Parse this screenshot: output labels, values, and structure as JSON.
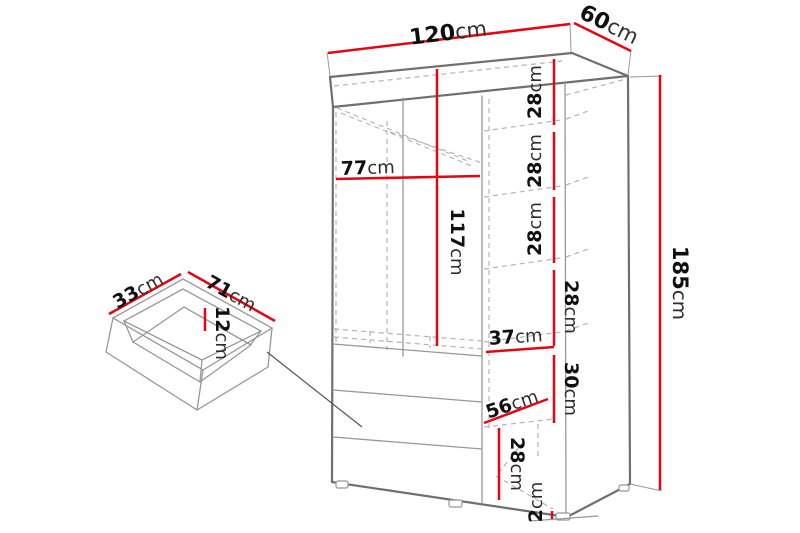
{
  "diagram": {
    "type": "furniture-dimension-diagram",
    "item": "wardrobe-with-drawer",
    "dims": {
      "width": {
        "num": "120",
        "unit": "cm"
      },
      "depth": {
        "num": "60",
        "unit": "cm"
      },
      "height": {
        "num": "185",
        "unit": "cm"
      },
      "left_section_width": {
        "num": "77",
        "unit": "cm"
      },
      "left_section_height": {
        "num": "117",
        "unit": "cm"
      },
      "shelf_gap_1": {
        "num": "28",
        "unit": "cm"
      },
      "shelf_gap_2": {
        "num": "28",
        "unit": "cm"
      },
      "shelf_gap_3": {
        "num": "28",
        "unit": "cm"
      },
      "shelf_gap_4": {
        "num": "28",
        "unit": "cm"
      },
      "shelf_width": {
        "num": "37",
        "unit": "cm"
      },
      "shelf_gap_5": {
        "num": "30",
        "unit": "cm"
      },
      "interior_depth": {
        "num": "56",
        "unit": "cm"
      },
      "shelf_gap_6": {
        "num": "28",
        "unit": "cm"
      },
      "plinth_height": {
        "num": "2",
        "unit": "cm"
      },
      "drawer_depth": {
        "num": "33",
        "unit": "cm"
      },
      "drawer_width": {
        "num": "71",
        "unit": "cm"
      },
      "drawer_height": {
        "num": "12",
        "unit": "cm"
      }
    },
    "colors": {
      "red": "#e30613",
      "outline": "#6f6f6f",
      "thin": "#989898",
      "dash": "#b3b3b3",
      "text": "#101010",
      "unit_text": "#2e2e2e"
    }
  }
}
